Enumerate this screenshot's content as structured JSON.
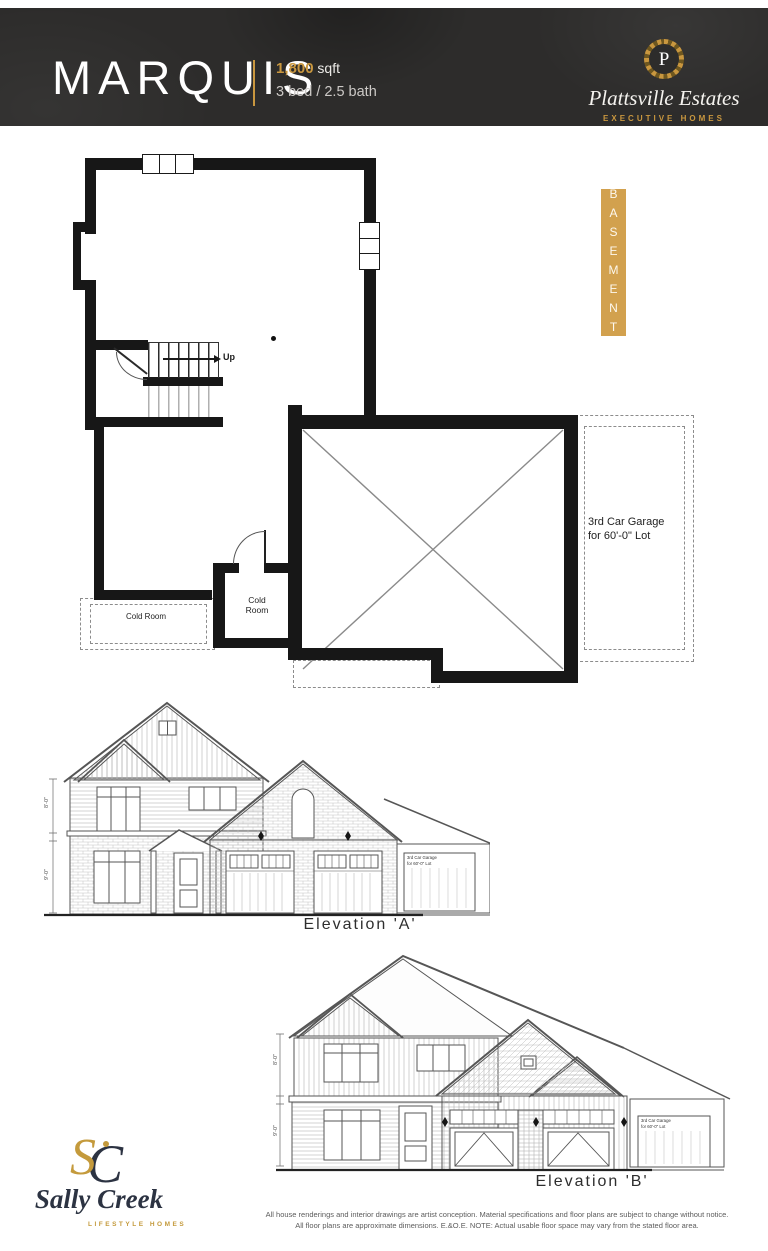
{
  "header": {
    "model_name": "MARQUIS",
    "area_value": "1,800",
    "area_unit": " sqft",
    "bed_bath": "3 bed / 2.5 bath",
    "builder": {
      "monogram": "P",
      "name": "Plattsville Estates",
      "tagline": "EXECUTIVE HOMES"
    }
  },
  "plan": {
    "tag": "BASEMENT",
    "up": "Up",
    "cold_room": "Cold Room",
    "cold_small_1": "Cold",
    "cold_small_2": "Room",
    "garage_note_1": "3rd Car Garage",
    "garage_note_2": "for 60'-0\" Lot"
  },
  "elevation_a": {
    "label": "Elevation 'A'",
    "garage_note_1": "3rd Car Garage",
    "garage_note_2": "for 60'-0\" Lot",
    "dim_upper": "8'-0\"",
    "dim_lower": "9'-0\""
  },
  "elevation_b": {
    "label": "Elevation 'B'",
    "garage_note_1": "3rd Car Garage",
    "garage_note_2": "for 60'-0\" Lot",
    "dim_upper": "8'-0\"",
    "dim_lower": "9'-0\""
  },
  "footer": {
    "monogram_s": "S",
    "monogram_c": "C",
    "brand_name": "Sally Creek",
    "brand_tagline": "LIFESTYLE HOMES",
    "disclaimer_1": "All house renderings and interior drawings are artist conception. Material specifications and floor plans are subject to change without notice.",
    "disclaimer_2": "All floor plans are approximate dimensions. E.&O.E. NOTE: Actual usable floor space may vary from the stated floor area."
  },
  "colors": {
    "header_bg": "#2d2c2b",
    "gold": "#c9973f",
    "tag_bg": "#d2a14e",
    "navy": "#2c3342"
  }
}
